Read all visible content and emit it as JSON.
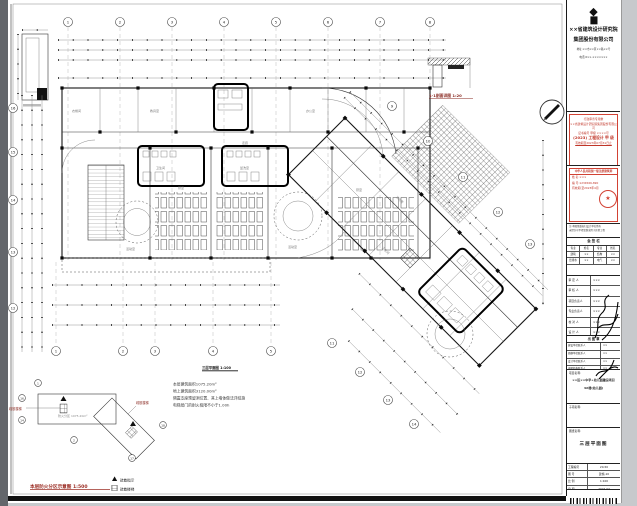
{
  "plan": {
    "caption": "三层平面图 1:100",
    "detail_caption": "1-1剖面详图 1:20",
    "grid_top": [
      "1",
      "2",
      "3",
      "4",
      "5",
      "6",
      "7",
      "8"
    ],
    "grid_bottom": [
      "1",
      "2",
      "3",
      "4",
      "5"
    ],
    "grid_left": [
      "16",
      "15",
      "14",
      "13",
      "12"
    ],
    "grid_ne": [
      "9",
      "10",
      "11",
      "12",
      "13"
    ],
    "grid_sw": [
      "11",
      "12",
      "13",
      "14"
    ],
    "room_labels": [
      "衣帽间",
      "教具室",
      "办公室",
      "卫生间",
      "盥洗室",
      "活动室",
      "活动室",
      "寝室",
      "寝室",
      "走廊",
      "活动室",
      "卫生间"
    ],
    "stair_label": "疏散楼梯"
  },
  "notes": {
    "lines": [
      "本层建筑面积1075.20m²",
      "地上建筑面积3120.00m²",
      "隔震支座预留洞位置、其上墙体做法详结施",
      "电梯层门的耐火极限不小于1.00h"
    ]
  },
  "keyplan": {
    "caption": "本层防火分区示意图 1:500",
    "area_label": "防火分区 1075.20m²",
    "stair_label_left": "疏散楼梯",
    "stair_label_right": "疏散楼梯",
    "bubbles": [
      "1",
      "16",
      "14",
      "2",
      "18",
      "17"
    ],
    "legend": [
      {
        "label": "疏散指示"
      },
      {
        "label": "疏散楼梯"
      }
    ]
  },
  "titleblock": {
    "company": {
      "logo_glyph": "◆",
      "logo_sub": "▆",
      "name1": "××省建筑设计研究院",
      "name2": "集团股份有限公司",
      "addr1": "地址:××市××区××路××号",
      "addr2": "电话:0××-×××××××"
    },
    "stamp1": {
      "l1": "行政审查专用章",
      "l2": "××省建筑设计研究院集团股份有限公司",
      "l3": "证书编号 甲级 ××××号",
      "l4": "(2023) 工程设计 甲 级",
      "l5": "有效期至2023年07月31日止"
    },
    "stamp2": {
      "title": "中华人民共和国一级注册建筑师",
      "r1": "姓 名:×××",
      "r2": "编 号:1234566-890",
      "r3": "有效期:至2023年4月",
      "seal_star": "★"
    },
    "note_l1": "注:本图纸版权归设计单位所有",
    "note_l2": "未经许可不得复制或用于其他工程",
    "huiqian": {
      "title": "会 签 栏",
      "rows": [
        [
          "专业",
          "姓名",
          "专业",
          "姓名"
        ],
        [
          "建筑",
          "××",
          "结构",
          "××"
        ],
        [
          "给排水",
          "××",
          "电气",
          "××"
        ]
      ]
    },
    "sign_rows": [
      [
        "审 定 人",
        "×××"
      ],
      [
        "审 核 人",
        "×××"
      ],
      [
        "项目负责人",
        "×××"
      ],
      [
        "专业负责人",
        "×××"
      ],
      [
        "校 对 人",
        "×××"
      ],
      [
        "设 计 人",
        "×××"
      ]
    ],
    "contacts_title": "出 图 章",
    "contacts": [
      [
        "建设单位联系人",
        "××"
      ],
      [
        "勘察单位联系人",
        "××"
      ],
      [
        "设计单位联系人",
        "××"
      ],
      [
        "审图机构联系人",
        "××"
      ]
    ],
    "project_label": "项目名称:",
    "project_value1": "××区××中学+幼儿园建设项目",
    "project_value2": "4#楼(幼儿园)",
    "subitem_label": "子项名称:",
    "drawing_label": "图纸名称:",
    "drawing_value": "三层平面图",
    "info_rows": [
      [
        "工程编号",
        "20-50"
      ],
      [
        "图  号",
        "建施-10"
      ],
      [
        "比  例",
        "1:100"
      ],
      [
        "日  期",
        "2022.07"
      ]
    ]
  }
}
